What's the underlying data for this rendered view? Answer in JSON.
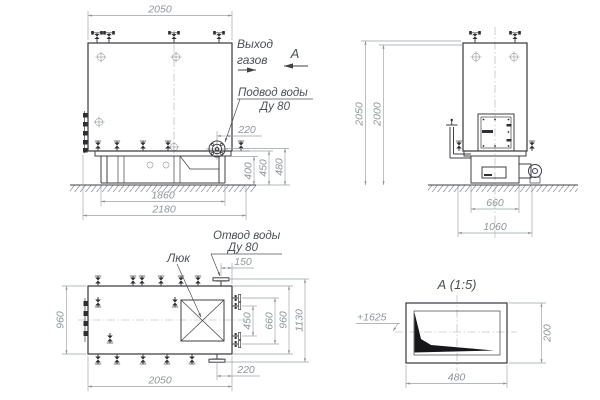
{
  "style": {
    "line_color": "#3f3f43",
    "dim_color": "#8f9599",
    "background": "#ffffff"
  },
  "front_view": {
    "dim_top_width": "2050",
    "dim_base_width": "1860",
    "dim_overall_width": "2180",
    "dim_inlet_offset": "220",
    "dim_h_400": "400",
    "dim_h_450": "450",
    "dim_h_480": "480",
    "label_gas_line1": "Выход",
    "label_gas_line2": "газов",
    "section_arrow_label": "А",
    "label_inlet_line1": "Подвод воды",
    "label_inlet_line2": "Ду 80"
  },
  "side_view": {
    "dim_height_overall": "2050",
    "dim_height_body": "2000",
    "dim_base_width": "660",
    "dim_overall_width": "1060"
  },
  "top_view": {
    "label_hatch": "Люк",
    "label_outlet_line1": "Отвод воды",
    "label_outlet_line2": "Ду 80",
    "dim_outlet_offset_top": "150",
    "dim_outlet_offset_bottom": "220",
    "dim_width_left": "960",
    "dim_length_bottom": "2050",
    "dim_flange_inner": "450",
    "dim_flange_outer": "660",
    "dim_body_width_right": "960",
    "dim_overall_height": "1130"
  },
  "detail_view": {
    "title": "А  (1:5)",
    "elevation_mark": "+1625",
    "dim_width": "480",
    "dim_height": "200"
  }
}
